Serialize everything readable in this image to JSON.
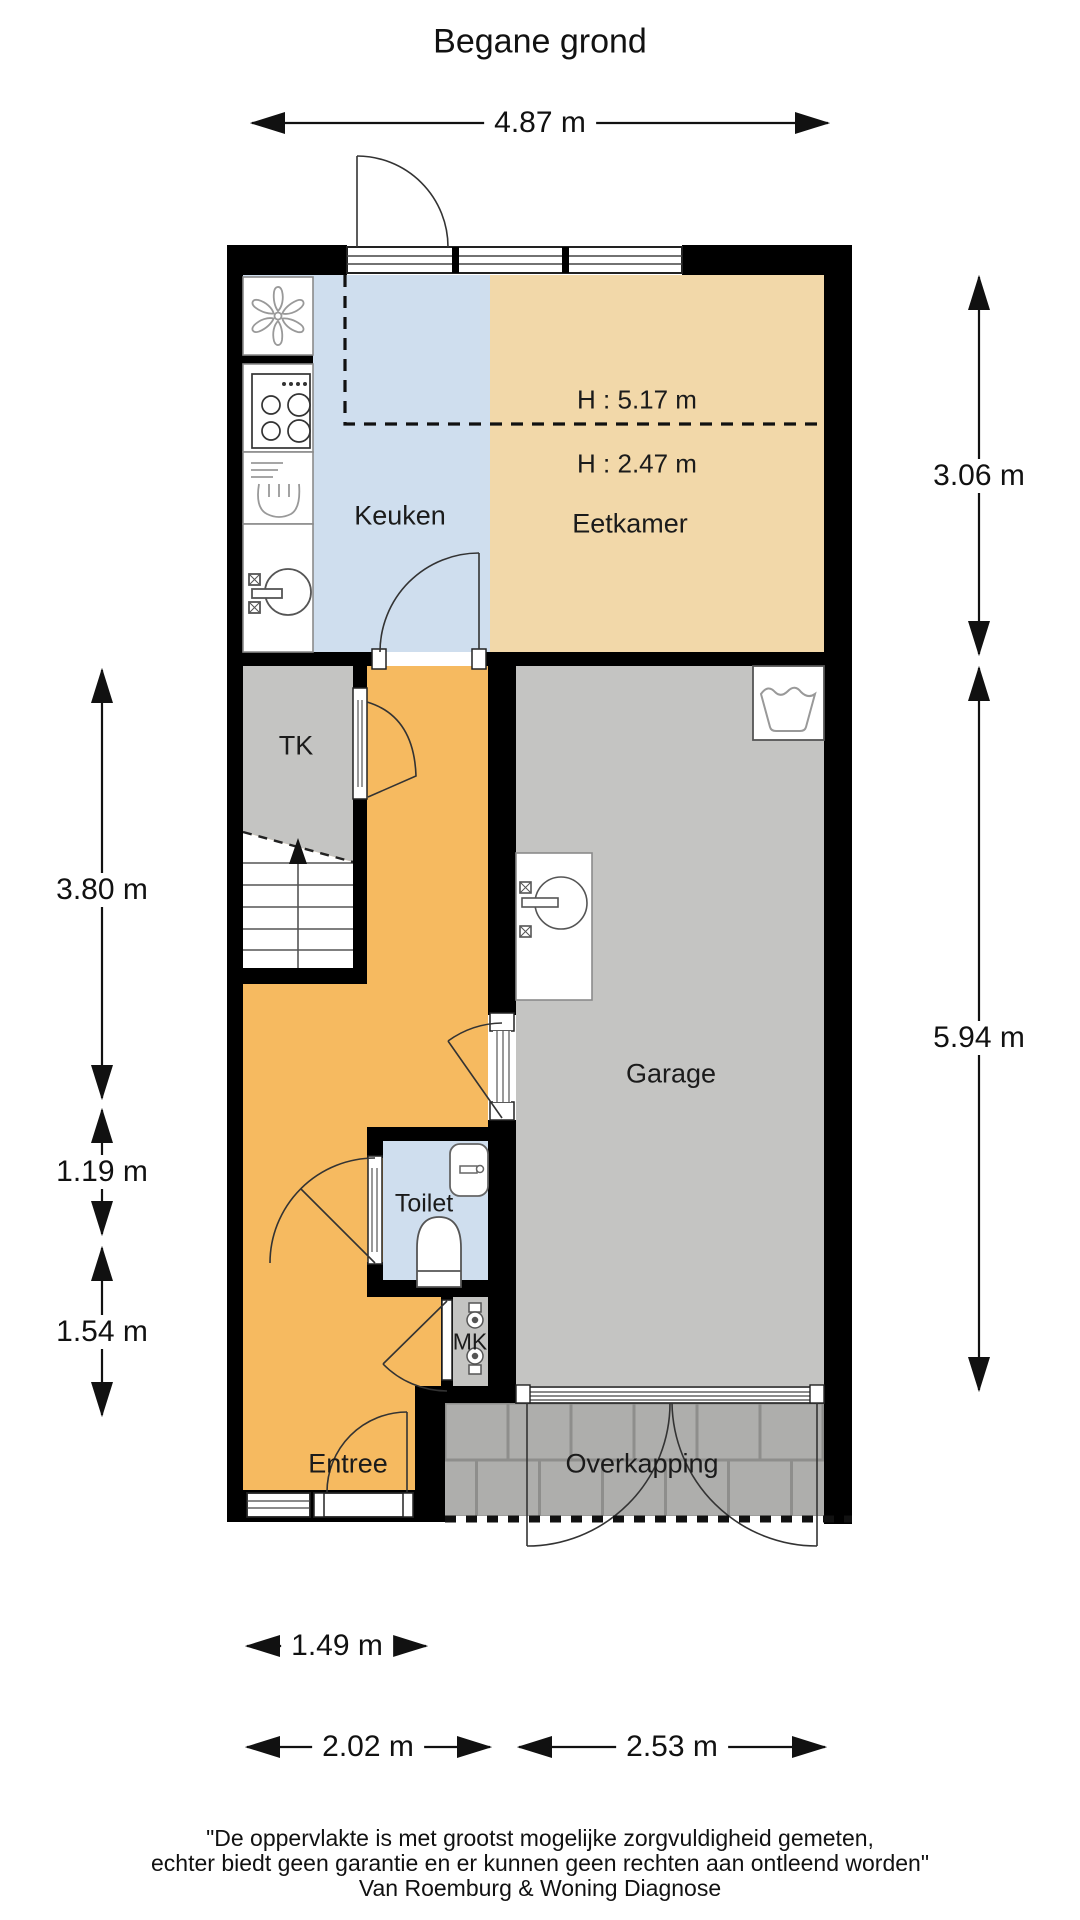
{
  "title": "Begane grond",
  "floor_plan": {
    "rooms": {
      "keuken": {
        "label": "Keuken"
      },
      "eetkamer": {
        "label": "Eetkamer",
        "height_note_upper": "H : 5.17 m",
        "height_note_lower": "H : 2.47 m"
      },
      "tk": {
        "label": "TK"
      },
      "garage": {
        "label": "Garage"
      },
      "toilet": {
        "label": "Toilet"
      },
      "mk": {
        "label": "MK"
      },
      "entree": {
        "label": "Entree"
      },
      "overkapping": {
        "label": "Overkapping"
      }
    },
    "dimensions": {
      "top_width": "4.87 m",
      "right_upper": "3.06 m",
      "right_lower": "5.94 m",
      "left_upper": "3.80 m",
      "left_middle": "1.19 m",
      "left_lower": "1.54 m",
      "bottom_entree": "1.49 m",
      "bottom_hall": "2.02 m",
      "bottom_garage": "2.53 m"
    },
    "colors": {
      "kitchen_blue": "#cfdeee",
      "dining_tan": "#f2d8a9",
      "hall_orange": "#f6ba60",
      "room_gray": "#c4c4c2",
      "tile_gray": "#aeaeac",
      "wall_black": "#000000"
    }
  },
  "footer": {
    "line1": "\"De oppervlakte is met grootst mogelijke zorgvuldigheid gemeten,",
    "line2": "echter biedt geen garantie en er kunnen geen rechten aan ontleend worden\"",
    "line3": "Van Roemburg & Woning Diagnose"
  }
}
